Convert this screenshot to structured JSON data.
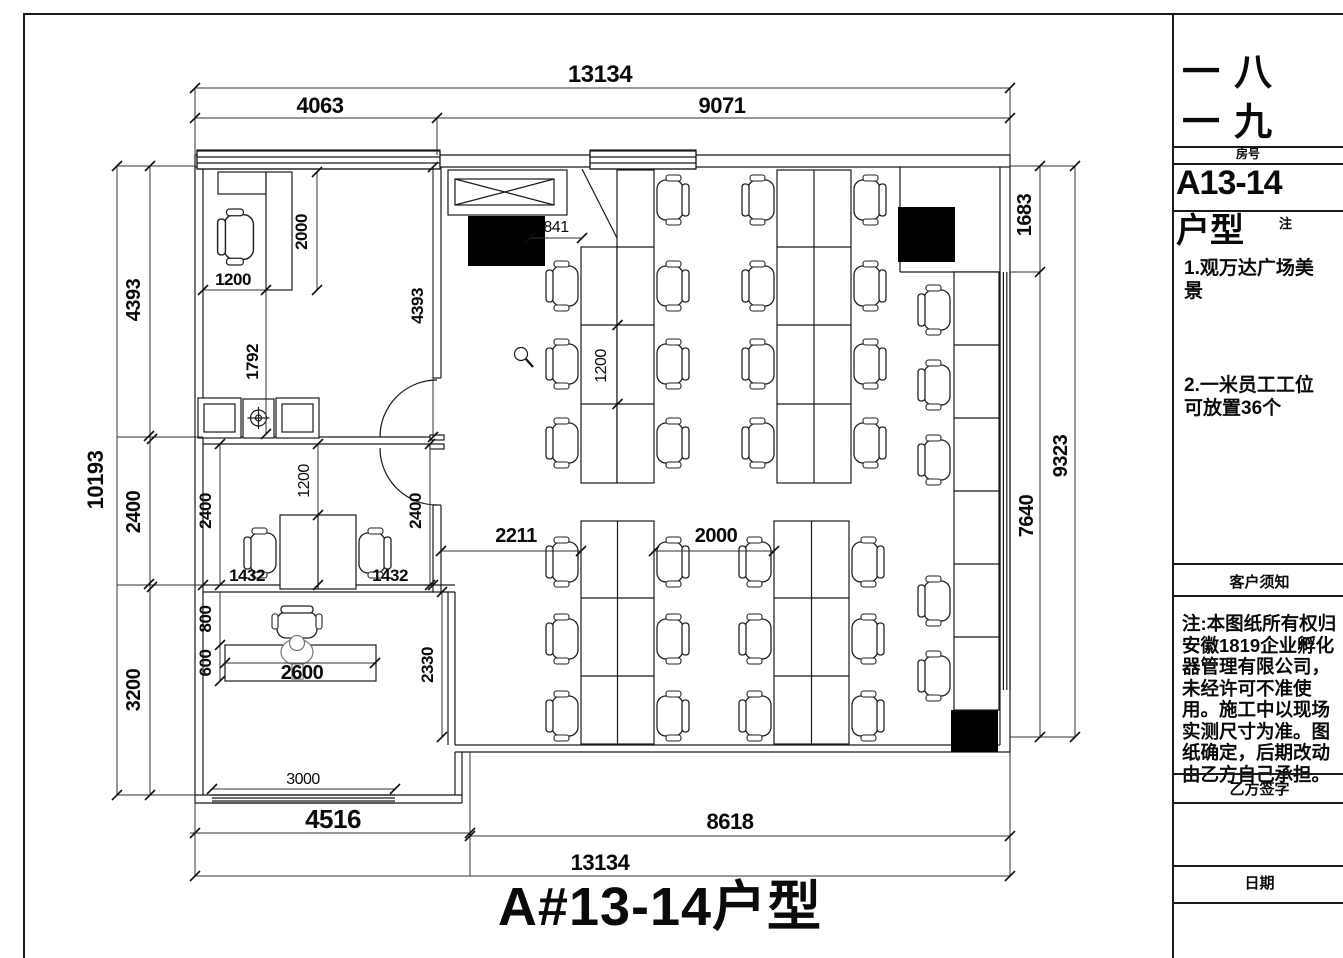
{
  "plan": {
    "title": "A#13-14户型",
    "dims": {
      "top_total": "13134",
      "top_left": "4063",
      "top_right": "9071",
      "left_total": "10193",
      "left_top": "4393",
      "left_mid": "2400",
      "left_bottom": "3200",
      "right_top": "1683",
      "right_bottom": "7640",
      "right_total": "9323",
      "office_depth": "2000",
      "office_width": "1200",
      "office_gap": "1792",
      "office_height": "4393",
      "entry": "841",
      "desk_run": "1200",
      "meeting_left": "2400",
      "meeting_table": "1200",
      "meeting_right": "2400",
      "meeting_seat_left": "1432",
      "meeting_seat_right": "1432",
      "aisle_left": "2211",
      "aisle_mid": "2000",
      "reception_back": "800",
      "reception_desk_depth": "600",
      "reception_desk_len": "2600",
      "reception_height": "2330",
      "window_bottom": "3000",
      "bottom_left": "4516",
      "bottom_right": "8618",
      "bottom_total": "13134"
    }
  },
  "sidebar": {
    "company": "一八一九",
    "room_label": "房号",
    "room_number": "A13-14",
    "type_label": "户型",
    "type_note_label": "注",
    "feature1": "1.观万达广场美景",
    "feature2": "2.一米员工工位可放置36个",
    "notice_header": "客户须知",
    "notice_body": "注:本图纸所有权归安徽1819企业孵化器管理有限公司，未经许可不准使用。施工中以现场实测尺寸为准。图纸确定，后期改动由乙方自己承担。",
    "sign_label": "乙方签字",
    "date_label": "日期"
  }
}
